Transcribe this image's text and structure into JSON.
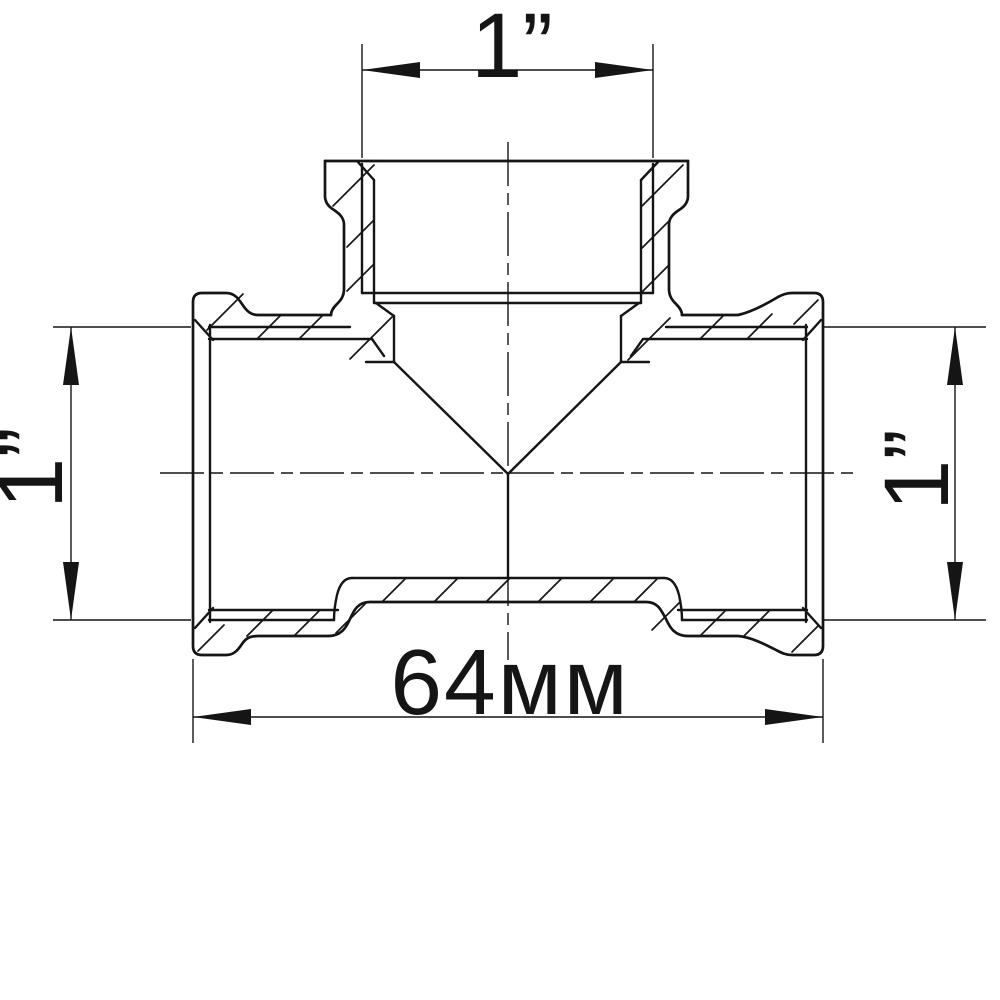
{
  "meta": {
    "type": "technical-drawing",
    "subject": "Threaded pipe tee fitting — sectional front view with dimensions"
  },
  "colors": {
    "background": "#ffffff",
    "line": "#151515"
  },
  "dimensions": {
    "top": {
      "label": "1”"
    },
    "left": {
      "label": "1”"
    },
    "right": {
      "label": "1”"
    },
    "bottom": {
      "label": "64мм"
    }
  }
}
